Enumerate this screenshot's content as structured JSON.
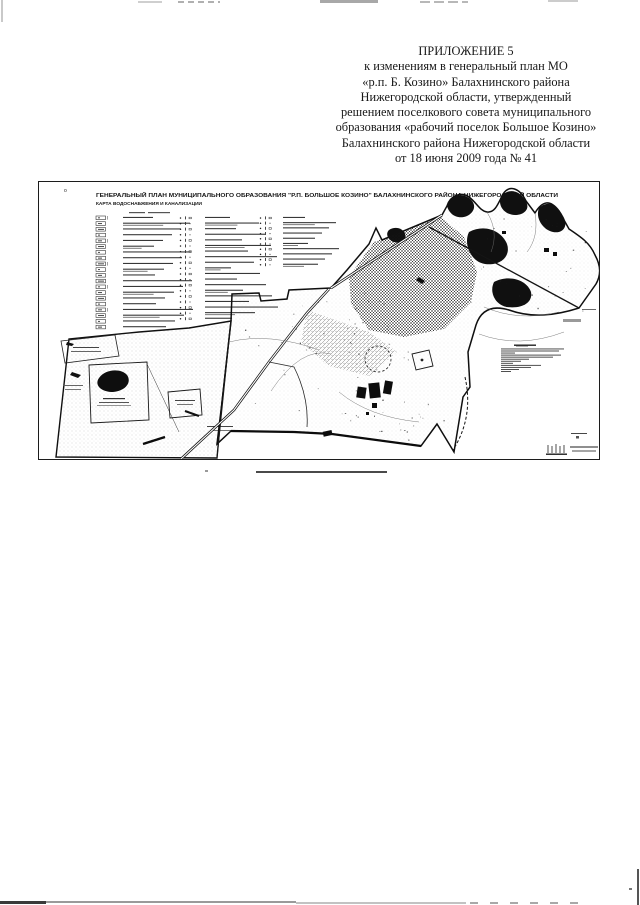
{
  "document": {
    "top_lines": [
      "ПРИЛОЖЕНИЕ 5",
      "к изменениям в генеральный план МО",
      "«р.п. Б. Козино» Балахнинского района",
      "Нижегородской области, утвержденный",
      "решением поселкового совета муниципального",
      "образования «рабочий поселок Большое Козино»",
      "Балахнинского района Нижегородской области",
      "от 18 июня 2009 года № 41"
    ]
  },
  "map": {
    "corner_mark": "о",
    "title": "ГЕНЕРАЛЬНЫЙ ПЛАН МУНИЦИПАЛЬНОГО ОБРАЗОВАНИЯ \"Р.П. БОЛЬШОЕ КОЗИНО\" БАЛАХНИНСКОГО РАЙОНА НИЖЕГОРОДСКОЙ ОБЛАСТИ",
    "subtitle": "КАРТА ВОДОСНАБЖЕНИЯ И КАНАЛИЗАЦИИ",
    "legend": {
      "columns": [
        {
          "rows": 20,
          "style": "box"
        },
        {
          "rows": 19,
          "style": "marks"
        },
        {
          "rows": 10,
          "style": "marks"
        }
      ]
    },
    "notes": {
      "line_count": 12,
      "line_widths": [
        63,
        58,
        14,
        60,
        52,
        28,
        20,
        12,
        40,
        30,
        18,
        10
      ]
    },
    "colors": {
      "ink": "#1b1b1b",
      "paper": "#ffffff"
    }
  }
}
